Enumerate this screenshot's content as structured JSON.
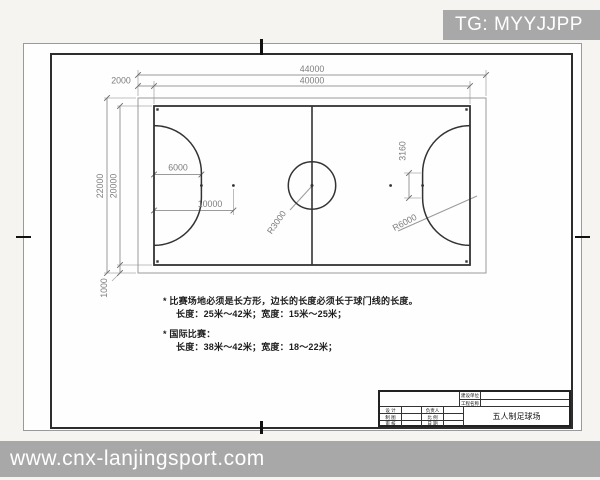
{
  "watermarks": {
    "top": "TG: MYYJJPP",
    "bottom": "www.cnx-lanjingsport.com"
  },
  "drawing": {
    "dim_total_width": "44000",
    "dim_court_width": "40000",
    "dim_side_margin": "2000",
    "dim_total_height": "22000",
    "dim_court_height": "20000",
    "dim_bottom_margin": "1000",
    "dim_penalty_6m": "6000",
    "dim_penalty_10m": "10000",
    "dim_goal_segment": "3160",
    "label_center_circle": "R3000",
    "label_penalty_arc": "R6000"
  },
  "notes": {
    "line1": "* 比赛场地必须是长方形，边长的长度必须长于球门线的长度。",
    "line2": "长度：25米～42米；宽度：15米～25米；",
    "line3": "* 国际比赛：",
    "line4": "长度：38米～42米；宽度：18～22米；"
  },
  "title_block": {
    "owner_label": "建设单位",
    "project_label": "工程名称",
    "design_label": "设 计",
    "draft_label": "制 图",
    "review_label": "审 核",
    "lead_label": "负责人",
    "scale_label": "比 例",
    "date_label": "日 期",
    "drawing_title": "五人制足球场"
  },
  "colors": {
    "court_line": "#333333",
    "dimension_line": "#9a9a9a",
    "watermark_bg": "#a8a8a8",
    "watermark_text": "#ffffff",
    "sheet_frame": "#2d2d2d"
  }
}
